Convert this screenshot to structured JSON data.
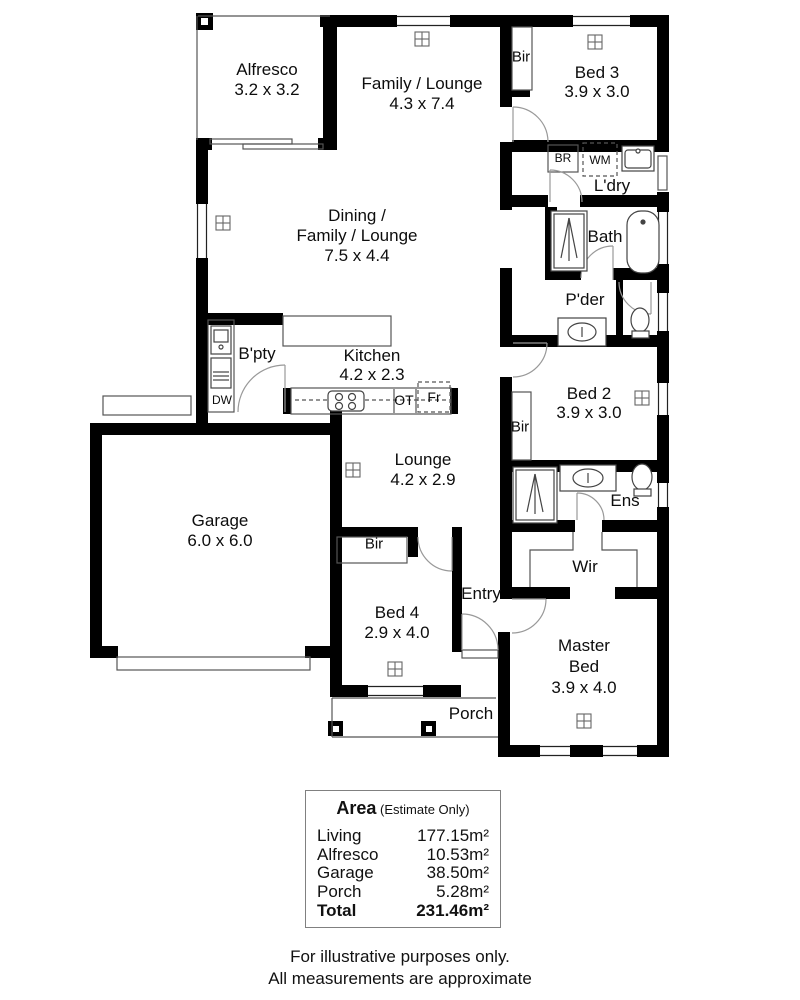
{
  "plan": {
    "rooms": {
      "alfresco": {
        "name": "Alfresco",
        "dims": "3.2 x 3.2"
      },
      "family_lounge": {
        "name": "Family / Lounge",
        "dims": "4.3 x 7.4"
      },
      "bed3": {
        "name": "Bed 3",
        "dims": "3.9 x 3.0"
      },
      "bir_top": {
        "name": "Bir"
      },
      "ldry": {
        "name": "L'dry"
      },
      "bath": {
        "name": "Bath"
      },
      "pder": {
        "name": "P'der"
      },
      "dining": {
        "line1": "Dining /",
        "line2": "Family / Lounge",
        "dims": "7.5 x 4.4"
      },
      "bpty": {
        "name": "B'pty"
      },
      "kitchen": {
        "name": "Kitchen",
        "dims": "4.2 x 2.3"
      },
      "bed2": {
        "name": "Bed 2",
        "dims": "3.9 x 3.0"
      },
      "bir_bed2": {
        "name": "Bir"
      },
      "garage": {
        "name": "Garage",
        "dims": "6.0 x 6.0"
      },
      "lounge": {
        "name": "Lounge",
        "dims": "4.2 x 2.9"
      },
      "bir_bed4": {
        "name": "Bir"
      },
      "bed4": {
        "name": "Bed 4",
        "dims": "2.9 x 4.0"
      },
      "entry": {
        "name": "Entry"
      },
      "ens": {
        "name": "Ens"
      },
      "wir": {
        "name": "Wir"
      },
      "master": {
        "line1": "Master",
        "line2": "Bed",
        "dims": "3.9 x 4.0"
      },
      "porch": {
        "name": "Porch"
      }
    },
    "fixtures": {
      "br": "BR",
      "wm": "WM",
      "dw": "DW",
      "ot": "OT",
      "fr": "Fr"
    },
    "colors": {
      "wall": "#000000",
      "thin_line": "#555555",
      "door_arc": "#999999"
    }
  },
  "area_table": {
    "title": "Area",
    "subtitle": "(Estimate Only)",
    "rows": [
      {
        "name": "Living",
        "value": "177.15m²"
      },
      {
        "name": "Alfresco",
        "value": "10.53m²"
      },
      {
        "name": "Garage",
        "value": "38.50m²"
      },
      {
        "name": "Porch",
        "value": "5.28m²"
      }
    ],
    "total_label": "Total",
    "total_value": "231.46m²"
  },
  "footer": {
    "line1": "For illustrative purposes only.",
    "line2": "All measurements are approximate"
  }
}
